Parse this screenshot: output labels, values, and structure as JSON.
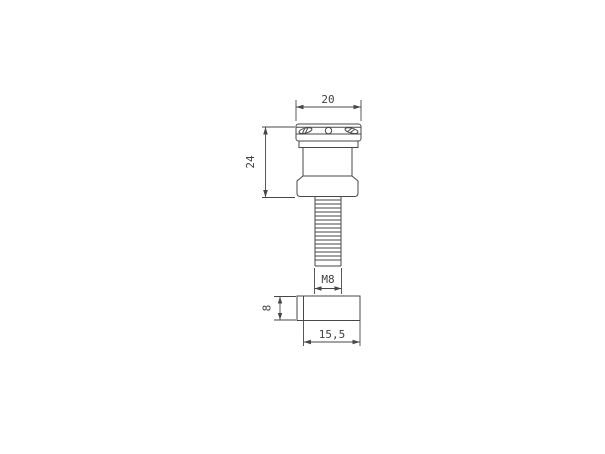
{
  "drawing": {
    "background_color": "#ffffff",
    "line_color": "#474747",
    "dimensions": {
      "head_diameter": "20",
      "spool_height": "24",
      "thread_size": "M8",
      "spacer_thickness": "8",
      "spacer_length": "15,5"
    }
  }
}
